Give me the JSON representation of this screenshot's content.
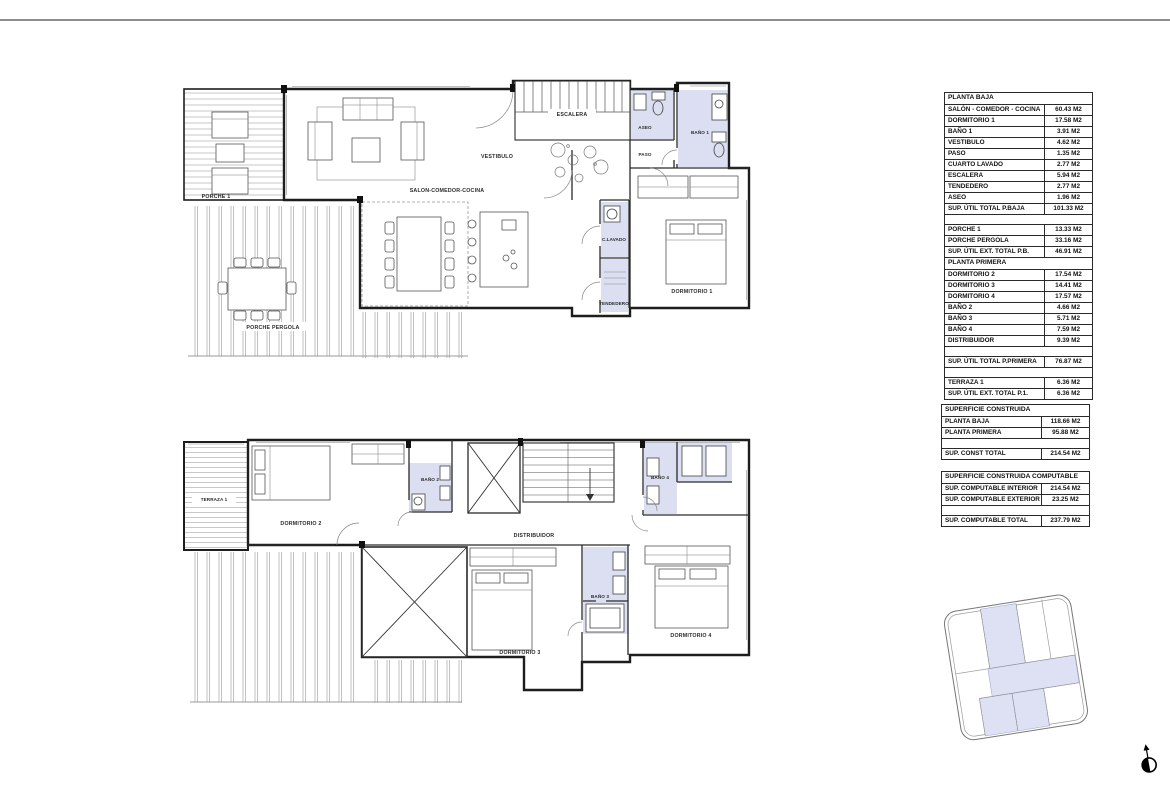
{
  "colors": {
    "wet_room_fill": "#dbdff1",
    "parcel_fill": "#dde1f3",
    "wall": "#1d1d1d",
    "rule": "#8d8d8d"
  },
  "plans": {
    "baja": {
      "labels": [
        {
          "text": "PORCHE 1"
        },
        {
          "text": "SALON-COMEDOR-COCINA"
        },
        {
          "text": "VESTIBULO"
        },
        {
          "text": "ESCALERA"
        },
        {
          "text": "ASEO"
        },
        {
          "text": "PASO"
        },
        {
          "text": "BAÑO 1"
        },
        {
          "text": "C.LAVADO"
        },
        {
          "text": "TENDEDERO"
        },
        {
          "text": "DORMITORIO 1"
        },
        {
          "text": "PORCHE PERGOLA"
        }
      ]
    },
    "primera": {
      "labels": [
        {
          "text": "TERRAZA 1"
        },
        {
          "text": "DORMITORIO 2"
        },
        {
          "text": "BAÑO 2"
        },
        {
          "text": "DISTRIBUIDOR"
        },
        {
          "text": "BAÑO 4"
        },
        {
          "text": "BAÑO 3"
        },
        {
          "text": "DORMITORIO 3"
        },
        {
          "text": "DORMITORIO 4"
        }
      ]
    }
  },
  "tables": [
    {
      "title": "PLANTA BAJA",
      "rows": [
        {
          "label": "SALÓN - COMEDOR - COCINA",
          "value": "60.43 M2"
        },
        {
          "label": "DORMITORIO 1",
          "value": "17.58 M2"
        },
        {
          "label": "BAÑO 1",
          "value": "3.91 M2"
        },
        {
          "label": "VESTIBULO",
          "value": "4.62 M2"
        },
        {
          "label": "PASO",
          "value": "1.35 M2"
        },
        {
          "label": "CUARTO LAVADO",
          "value": "2.77 M2"
        },
        {
          "label": "ESCALERA",
          "value": "5.94 M2"
        },
        {
          "label": "TENDEDERO",
          "value": "2.77 M2"
        },
        {
          "label": "ASEO",
          "value": "1.96 M2"
        },
        {
          "label": "SUP. ÚTIL TOTAL P.BAJA",
          "value": "101.33 M2"
        },
        {
          "label": "PORCHE 1",
          "value": "13.33 M2"
        },
        {
          "label": "PORCHE PERGOLA",
          "value": "33.16 M2"
        },
        {
          "label": "SUP. ÚTIL  EXT. TOTAL P.B.",
          "value": "46.91 M2"
        }
      ]
    },
    {
      "title": "PLANTA PRIMERA",
      "rows": [
        {
          "label": "DORMITORIO 2",
          "value": "17.54 M2"
        },
        {
          "label": "DORMITORIO 3",
          "value": "14.41 M2"
        },
        {
          "label": "DORMITORIO 4",
          "value": "17.57 M2"
        },
        {
          "label": "BAÑO 2",
          "value": "4.66 M2"
        },
        {
          "label": "BAÑO 3",
          "value": "5.71 M2"
        },
        {
          "label": "BAÑO 4",
          "value": "7.59 M2"
        },
        {
          "label": "DISTRIBUIDOR",
          "value": "9.39 M2"
        },
        {
          "label": "SUP. ÚTIL TOTAL P.PRIMERA",
          "value": "76.87 M2"
        },
        {
          "label": "TERRAZA 1",
          "value": "6.36 M2"
        },
        {
          "label": "SUP. ÚTIL  EXT. TOTAL P.1.",
          "value": "6.36 M2"
        }
      ]
    },
    {
      "title": "SUPERFICIE CONSTRUIDA",
      "rows": [
        {
          "label": "PLANTA BAJA",
          "value": "118.66 M2"
        },
        {
          "label": "PLANTA PRIMERA",
          "value": "95.88 M2"
        },
        {
          "label": "SUP. CONST TOTAL",
          "value": "214.54 M2"
        }
      ]
    },
    {
      "title": "SUPERFICIE CONSTRUIDA COMPUTABLE",
      "rows": [
        {
          "label": "SUP. COMPUTABLE INTERIOR",
          "value": "214.54 M2"
        },
        {
          "label": "SUP. COMPUTABLE EXTERIOR",
          "value": "23.25 M2"
        },
        {
          "label": "SUP. COMPUTABLE TOTAL",
          "value": "237.79 M2"
        }
      ]
    }
  ]
}
